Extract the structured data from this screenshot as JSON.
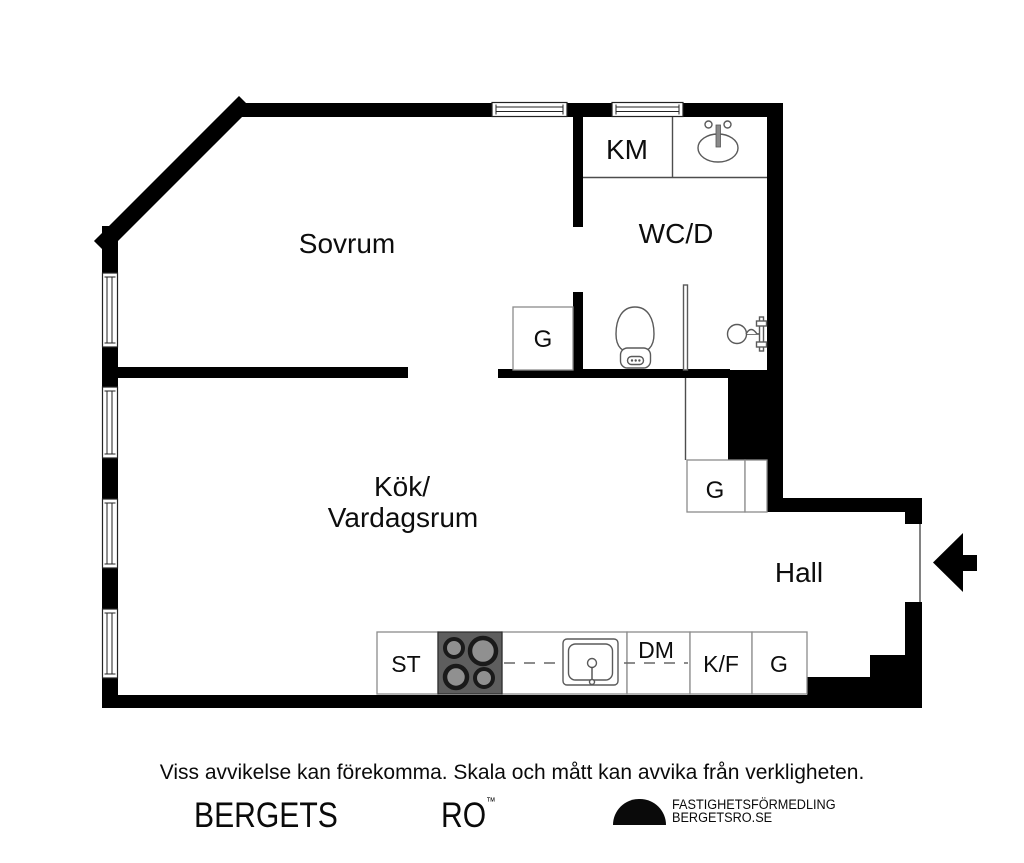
{
  "rooms": {
    "sovrum": "Sovrum",
    "wcd": "WC/D",
    "km": "KM",
    "kok_line1": "Kök/",
    "kok_line2": "Vardagsrum",
    "hall": "Hall"
  },
  "storage": {
    "g_bedroom": "G",
    "g_hall": "G",
    "g_kitchen": "G"
  },
  "kitchen_units": {
    "st": "ST",
    "dm": "DM",
    "kf": "K/F"
  },
  "fixtures": [
    "toilet-icon",
    "bathroom-sink-icon",
    "shower-mixer-icon",
    "shower-screen",
    "kitchen-sink-icon",
    "cooktop-icon",
    "entrance-arrow-icon",
    "window-icon"
  ],
  "footer": {
    "disclaimer": "Viss avvikelse kan förekomma. Skala och mått kan avvika från verkligheten.",
    "brand_left": "BERGETS",
    "brand_right": "RO",
    "trademark": "™",
    "agency_line1": "FASTIGHETSFÖRMEDLING",
    "agency_line2": "BERGETSRO.SE"
  },
  "colors": {
    "wall": "#000000",
    "fixture_line": "#5a5a5a",
    "unit_border": "#8c8c8c",
    "cooktop_bg": "#5e5e5e",
    "burner_ring": "#1a1a1a",
    "burner_center": "#909090",
    "text": "#0d0d0d"
  }
}
